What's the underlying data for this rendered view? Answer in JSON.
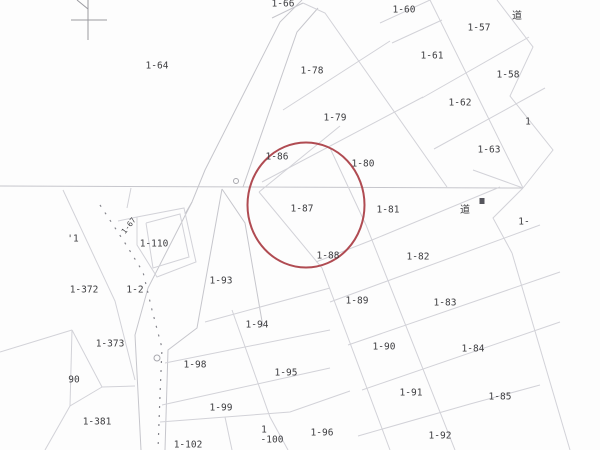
{
  "map": {
    "background": "#fdfdfd",
    "colors": {
      "parcel_line": "#d2d2d8",
      "road_line": "#c6c6cc",
      "dotted_line": "#85858c",
      "cross_mark": "#9a9aa0",
      "label_text": "#3d3d40",
      "highlight_red": "#b04b52"
    },
    "highlight": {
      "shape": "ellipse",
      "cx": 306,
      "cy": 205,
      "rx": 58.5,
      "ry": 62.5,
      "stroke_width": 2,
      "parcel": "1-87"
    },
    "labels": [
      {
        "text": "1-64",
        "x": 157,
        "y": 66,
        "size": 9.5,
        "rot": 0
      },
      {
        "text": "1-66",
        "x": 283,
        "y": 4,
        "size": 9.5,
        "rot": 0
      },
      {
        "text": "1-60",
        "x": 404,
        "y": 10,
        "size": 9.5,
        "rot": 0
      },
      {
        "text": "道",
        "x": 517,
        "y": 16,
        "size": 10,
        "rot": 0
      },
      {
        "text": "1-57",
        "x": 479,
        "y": 28,
        "size": 9.5,
        "rot": 0
      },
      {
        "text": "1-61",
        "x": 432,
        "y": 56,
        "size": 9.5,
        "rot": 0
      },
      {
        "text": "1-78",
        "x": 312,
        "y": 71,
        "size": 9.5,
        "rot": 0
      },
      {
        "text": "1-58",
        "x": 508,
        "y": 75,
        "size": 9.5,
        "rot": 0
      },
      {
        "text": "1-62",
        "x": 460,
        "y": 103,
        "size": 9.5,
        "rot": 0
      },
      {
        "text": "1-79",
        "x": 335,
        "y": 118,
        "size": 9.5,
        "rot": 0
      },
      {
        "text": "1",
        "x": 528,
        "y": 122,
        "size": 9.5,
        "rot": 0
      },
      {
        "text": "1-63",
        "x": 489,
        "y": 150,
        "size": 9.5,
        "rot": 0
      },
      {
        "text": "1-86",
        "x": 277,
        "y": 157,
        "size": 9.5,
        "rot": 0
      },
      {
        "text": "1-80",
        "x": 363,
        "y": 164,
        "size": 9.5,
        "rot": 0
      },
      {
        "text": "1-87",
        "x": 302,
        "y": 209,
        "size": 9.5,
        "rot": 0
      },
      {
        "text": "1-81",
        "x": 388,
        "y": 210,
        "size": 9.5,
        "rot": 0
      },
      {
        "text": "道",
        "x": 465,
        "y": 210,
        "size": 10,
        "rot": 0
      },
      {
        "text": "1-",
        "x": 524,
        "y": 222,
        "size": 9.5,
        "rot": 0
      },
      {
        "text": "1-67",
        "x": 129,
        "y": 226,
        "size": 7.5,
        "rot": -52
      },
      {
        "text": "'1",
        "x": 73,
        "y": 239,
        "size": 9.5,
        "rot": 0
      },
      {
        "text": "1-110",
        "x": 154,
        "y": 244,
        "size": 9.5,
        "rot": 0
      },
      {
        "text": "1-88",
        "x": 328,
        "y": 256,
        "size": 9.5,
        "rot": 0
      },
      {
        "text": "1-82",
        "x": 418,
        "y": 257,
        "size": 9.5,
        "rot": 0
      },
      {
        "text": "1-93",
        "x": 221,
        "y": 281,
        "size": 9.5,
        "rot": 0
      },
      {
        "text": "1-372",
        "x": 84,
        "y": 290,
        "size": 9.5,
        "rot": 0
      },
      {
        "text": "1-2",
        "x": 135,
        "y": 290,
        "size": 9.5,
        "rot": 0
      },
      {
        "text": "1-89",
        "x": 357,
        "y": 301,
        "size": 9.5,
        "rot": 0
      },
      {
        "text": "1-83",
        "x": 445,
        "y": 303,
        "size": 9.5,
        "rot": 0
      },
      {
        "text": "1-94",
        "x": 257,
        "y": 325,
        "size": 9.5,
        "rot": 0
      },
      {
        "text": "1-373",
        "x": 110,
        "y": 344,
        "size": 9.5,
        "rot": 0
      },
      {
        "text": "1-90",
        "x": 384,
        "y": 347,
        "size": 9.5,
        "rot": 0
      },
      {
        "text": "1-84",
        "x": 473,
        "y": 349,
        "size": 9.5,
        "rot": 0
      },
      {
        "text": "1-98",
        "x": 195,
        "y": 365,
        "size": 9.5,
        "rot": 0
      },
      {
        "text": "1-95",
        "x": 286,
        "y": 373,
        "size": 9.5,
        "rot": 0
      },
      {
        "text": "90",
        "x": 74,
        "y": 380,
        "size": 9.5,
        "rot": 0
      },
      {
        "text": "1-91",
        "x": 411,
        "y": 393,
        "size": 9.5,
        "rot": 0
      },
      {
        "text": "1-85",
        "x": 500,
        "y": 397,
        "size": 9.5,
        "rot": 0
      },
      {
        "text": "1-99",
        "x": 221,
        "y": 408,
        "size": 9.5,
        "rot": 0
      },
      {
        "text": "1-381",
        "x": 97,
        "y": 422,
        "size": 9.5,
        "rot": 0
      },
      {
        "text": "1",
        "x": 264,
        "y": 430,
        "size": 9.5,
        "rot": 0
      },
      {
        "text": "1-96",
        "x": 322,
        "y": 433,
        "size": 9.5,
        "rot": 0
      },
      {
        "text": "1-92",
        "x": 440,
        "y": 436,
        "size": 9.5,
        "rot": 0
      },
      {
        "text": "-100",
        "x": 272,
        "y": 440,
        "size": 9.5,
        "rot": 0
      },
      {
        "text": "1-102",
        "x": 188,
        "y": 445,
        "size": 9.5,
        "rot": 0
      }
    ],
    "lines": [
      {
        "cls": "cross-line",
        "pts": [
          [
            88,
            0
          ],
          [
            88,
            40
          ]
        ]
      },
      {
        "cls": "cross-line",
        "pts": [
          [
            71,
            20
          ],
          [
            107,
            20
          ]
        ]
      },
      {
        "cls": "cross-line",
        "pts": [
          [
            77,
            0
          ],
          [
            88,
            9
          ]
        ]
      },
      {
        "cls": "road-line",
        "pts": [
          [
            0,
            186
          ],
          [
            523,
            188
          ]
        ]
      },
      {
        "cls": "road-line",
        "pts": [
          [
            302,
            0
          ],
          [
            280,
            22
          ],
          [
            205,
            170
          ],
          [
            192,
            202
          ],
          [
            185,
            214
          ]
        ]
      },
      {
        "cls": "road-line",
        "pts": [
          [
            272,
            18
          ],
          [
            303,
            3
          ]
        ]
      },
      {
        "cls": "road-line",
        "pts": [
          [
            318,
            8
          ],
          [
            297,
            32
          ],
          [
            243,
            187
          ]
        ]
      },
      {
        "cls": "road-line",
        "pts": [
          [
            192,
            202
          ],
          [
            148,
            288
          ],
          [
            135,
            335
          ],
          [
            141,
            450
          ]
        ]
      },
      {
        "cls": "dotted-line",
        "pts": [
          [
            100,
            205
          ],
          [
            125,
            243
          ],
          [
            143,
            272
          ],
          [
            152,
            310
          ],
          [
            162,
            348
          ],
          [
            160,
            395
          ],
          [
            158,
            450
          ]
        ]
      },
      {
        "cls": "road-line",
        "pts": [
          [
            222,
            189
          ],
          [
            197,
            328
          ],
          [
            168,
            350
          ],
          [
            165,
            450
          ]
        ]
      },
      {
        "cls": "road-line",
        "pts": [
          [
            222,
            189
          ],
          [
            245,
            223
          ],
          [
            263,
            327
          ]
        ]
      },
      {
        "cls": "parcel-line",
        "pts": [
          [
            303,
            3
          ],
          [
            325,
            13
          ],
          [
            447,
            187
          ]
        ]
      },
      {
        "cls": "parcel-line",
        "pts": [
          [
            430,
            0
          ],
          [
            523,
            188
          ]
        ]
      },
      {
        "cls": "parcel-line",
        "pts": [
          [
            497,
            0
          ],
          [
            533,
            47
          ],
          [
            510,
            96
          ],
          [
            553,
            150
          ],
          [
            523,
            188
          ]
        ]
      },
      {
        "cls": "parcel-line",
        "pts": [
          [
            380,
            23
          ],
          [
            430,
            0
          ]
        ]
      },
      {
        "cls": "parcel-line",
        "pts": [
          [
            392,
            43
          ],
          [
            442,
            20
          ]
        ]
      },
      {
        "cls": "parcel-line",
        "pts": [
          [
            422,
            98
          ],
          [
            529,
            37
          ]
        ]
      },
      {
        "cls": "parcel-line",
        "pts": [
          [
            434,
            149
          ],
          [
            545,
            88
          ]
        ]
      },
      {
        "cls": "parcel-line",
        "pts": [
          [
            473,
            170
          ],
          [
            523,
            188
          ]
        ]
      },
      {
        "cls": "parcel-line",
        "pts": [
          [
            283,
            110
          ],
          [
            390,
            41
          ]
        ]
      },
      {
        "cls": "parcel-line",
        "pts": [
          [
            262,
            182
          ],
          [
            423,
            97
          ]
        ]
      },
      {
        "cls": "parcel-line",
        "pts": [
          [
            259,
            192
          ],
          [
            340,
            126
          ]
        ]
      },
      {
        "cls": "parcel-line",
        "pts": [
          [
            259,
            192
          ],
          [
            322,
            268
          ],
          [
            390,
            450
          ]
        ]
      },
      {
        "cls": "parcel-line",
        "pts": [
          [
            330,
            148
          ],
          [
            366,
            225
          ],
          [
            455,
            450
          ]
        ]
      },
      {
        "cls": "parcel-line",
        "pts": [
          [
            523,
            188
          ],
          [
            493,
            218
          ],
          [
            512,
            253
          ]
        ]
      },
      {
        "cls": "parcel-line",
        "pts": [
          [
            512,
            253
          ],
          [
            570,
            450
          ]
        ]
      },
      {
        "cls": "parcel-line",
        "pts": [
          [
            316,
            262
          ],
          [
            372,
            240
          ],
          [
            500,
            187
          ]
        ]
      },
      {
        "cls": "parcel-line",
        "pts": [
          [
            330,
            302
          ],
          [
            540,
            225
          ]
        ]
      },
      {
        "cls": "parcel-line",
        "pts": [
          [
            348,
            345
          ],
          [
            560,
            272
          ]
        ]
      },
      {
        "cls": "parcel-line",
        "pts": [
          [
            362,
            390
          ],
          [
            560,
            322
          ]
        ]
      },
      {
        "cls": "parcel-line",
        "pts": [
          [
            358,
            436
          ],
          [
            470,
            404
          ],
          [
            540,
            385
          ]
        ]
      },
      {
        "cls": "parcel-line",
        "pts": [
          [
            205,
            322
          ],
          [
            330,
            288
          ]
        ]
      },
      {
        "cls": "parcel-line",
        "pts": [
          [
            165,
            363
          ],
          [
            330,
            330
          ]
        ]
      },
      {
        "cls": "parcel-line",
        "pts": [
          [
            162,
            405
          ],
          [
            330,
            368
          ]
        ]
      },
      {
        "cls": "parcel-line",
        "pts": [
          [
            232,
            310
          ],
          [
            270,
            417
          ],
          [
            288,
            450
          ]
        ]
      },
      {
        "cls": "parcel-line",
        "pts": [
          [
            160,
            422
          ],
          [
            290,
            412
          ],
          [
            350,
            391
          ]
        ]
      },
      {
        "cls": "parcel-line",
        "pts": [
          [
            225,
            417
          ],
          [
            232,
            450
          ]
        ]
      },
      {
        "cls": "parcel-line",
        "pts": [
          [
            63,
            190
          ],
          [
            115,
            301
          ],
          [
            135,
            380
          ]
        ]
      },
      {
        "cls": "parcel-line",
        "pts": [
          [
            0,
            352
          ],
          [
            72,
            330
          ]
        ]
      },
      {
        "cls": "parcel-line",
        "pts": [
          [
            72,
            330
          ],
          [
            102,
            387
          ],
          [
            70,
            406
          ],
          [
            45,
            450
          ]
        ]
      },
      {
        "cls": "parcel-line",
        "pts": [
          [
            70,
            406
          ],
          [
            72,
            330
          ]
        ]
      },
      {
        "cls": "parcel-line",
        "pts": [
          [
            102,
            387
          ],
          [
            135,
            386
          ]
        ]
      },
      {
        "cls": "parcel-line",
        "pts": [
          [
            137,
            217
          ],
          [
            184,
            208
          ],
          [
            196,
            262
          ],
          [
            157,
            277
          ],
          [
            137,
            245
          ],
          [
            137,
            217
          ]
        ]
      },
      {
        "cls": "parcel-line",
        "pts": [
          [
            146,
            223
          ],
          [
            180,
            214
          ],
          [
            189,
            257
          ],
          [
            153,
            268
          ],
          [
            146,
            223
          ]
        ]
      },
      {
        "cls": "parcel-line",
        "pts": [
          [
            118,
            221
          ],
          [
            137,
            217
          ]
        ]
      },
      {
        "cls": "parcel-line",
        "pts": [
          [
            127,
            208
          ],
          [
            131,
            188
          ]
        ]
      }
    ],
    "symbols": [
      {
        "type": "circle",
        "x": 236,
        "y": 181,
        "r": 2.5
      },
      {
        "type": "circle",
        "x": 157,
        "y": 358,
        "r": 3
      },
      {
        "type": "square",
        "x": 482,
        "y": 201,
        "w": 5,
        "h": 6
      }
    ]
  }
}
